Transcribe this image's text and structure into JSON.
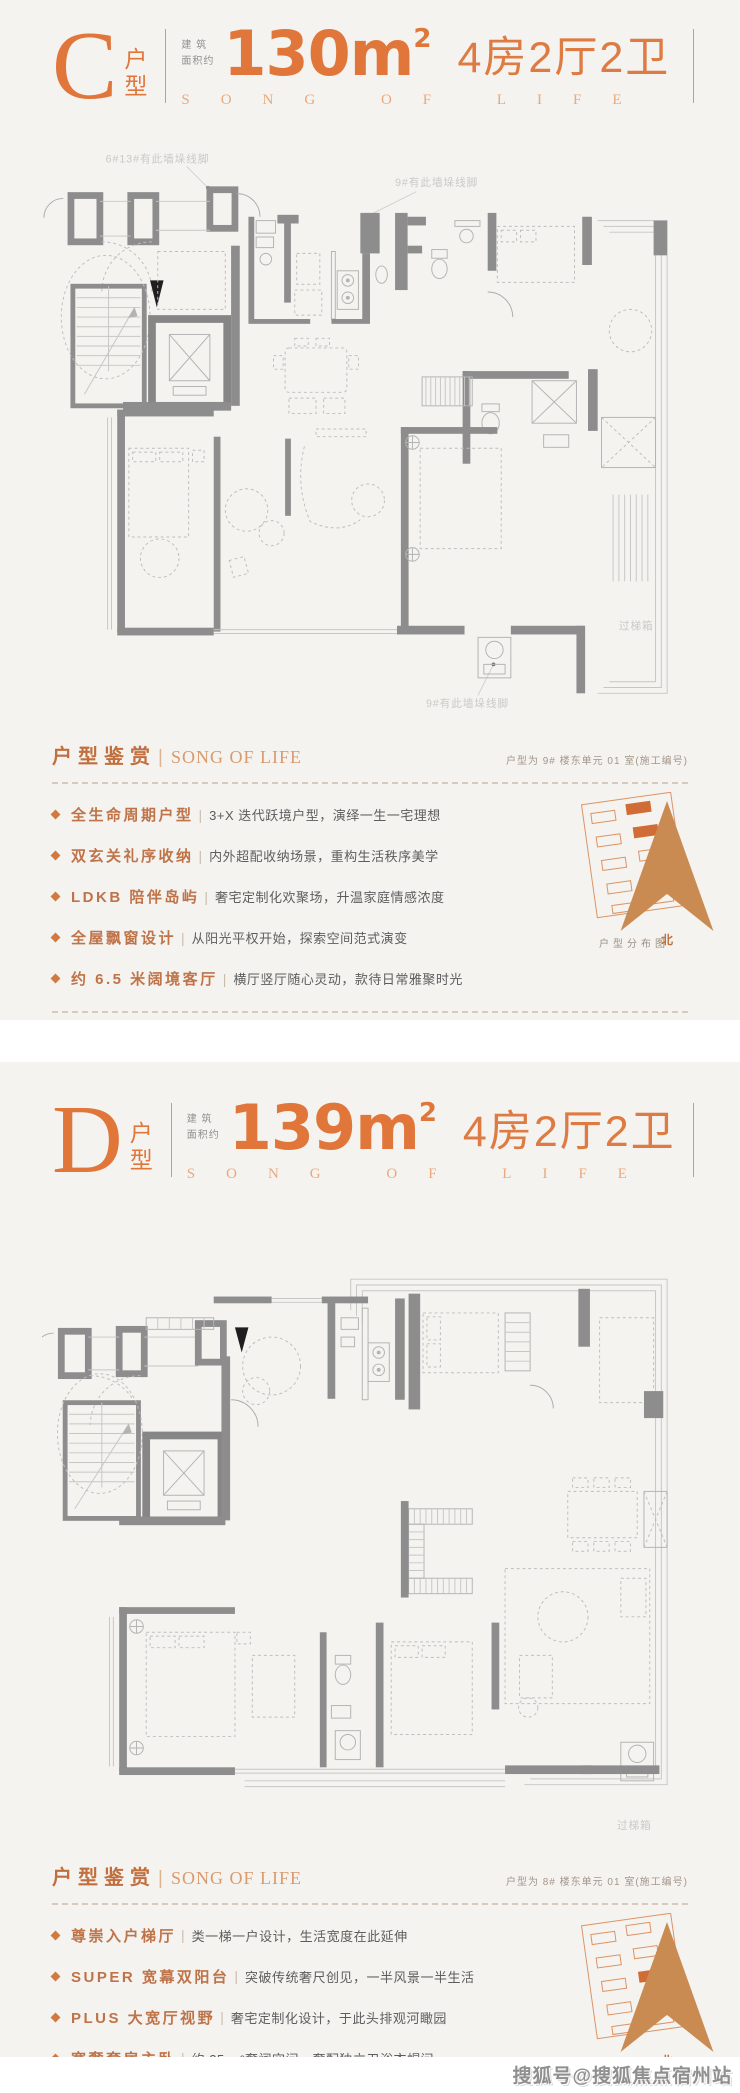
{
  "colors": {
    "accent": "#e1763b",
    "card_bg": "#f4f3f0",
    "section_head": "#c06f3d"
  },
  "watermark": "搜狐号@搜狐焦点宿州站",
  "cards": [
    {
      "letter": "C",
      "suffix": "户型",
      "area_label_1": "建 筑",
      "area_label_2": "面积约",
      "area_number": "130",
      "area_unit": "m",
      "area_sup": "2",
      "rooms": "4房2厅2卫",
      "subtitle": "SONG OF LIFE",
      "section": {
        "title": "户型鉴赏",
        "divider": "|",
        "title_en": "SONG OF LIFE",
        "note": "户型为 9# 楼东单元 01 室(施工编号)",
        "bullets": [
          {
            "head": "全生命周期户型",
            "desc": "3+X 迭代跃境户型，演绎一生一宅理想"
          },
          {
            "head": "双玄关礼序收纳",
            "desc": "内外超配收纳场景，重构生活秩序美学"
          },
          {
            "head": "LDKB 陪伴岛屿",
            "desc": "奢宅定制化欢聚场，升温家庭情感浓度"
          },
          {
            "head": "全屋飘窗设计",
            "desc": "从阳光平权开始，探索空间范式演变"
          },
          {
            "head": "约 6.5 米阔境客厅",
            "desc": "横厅竖厅随心灵动，款待日常雅聚时光"
          }
        ],
        "thumb_caption": "户型分布图",
        "compass_label": "北"
      },
      "plan_annotations": {
        "top_left": "6#13#有此墙垛线脚",
        "top_right": "9#有此墙垛线脚",
        "bottom": "9#有此墙垛线脚",
        "side": "过梯箱"
      }
    },
    {
      "letter": "D",
      "suffix": "户型",
      "area_label_1": "建 筑",
      "area_label_2": "面积约",
      "area_number": "139",
      "area_unit": "m",
      "area_sup": "2",
      "rooms": "4房2厅2卫",
      "subtitle": "SONG OF LIFE",
      "section": {
        "title": "户型鉴赏",
        "divider": "|",
        "title_en": "SONG OF LIFE",
        "note": "户型为 8# 楼东单元 01 室(施工编号)",
        "bullets": [
          {
            "head": "尊崇入户梯厅",
            "desc": "类一梯一户设计，生活宽度在此延伸"
          },
          {
            "head": "SUPER 宽幕双阳台",
            "desc": "突破传统奢尺创见，一半风景一半生活"
          },
          {
            "head": "PLUS 大宽厅视野",
            "desc": "奢宅定制化设计，于此头排观河瞰园"
          },
          {
            "head": "宽奢套房主卧",
            "desc": "约 25 m²奢阔空间，奢配独立卫浴衣帽间"
          },
          {
            "head": "270°转角飘窗",
            "desc": "无柱设计广角观景，四季于窗前成诗"
          }
        ],
        "thumb_caption": "户型分布图",
        "compass_label": "北"
      },
      "plan_annotations": {
        "side": "过梯箱"
      }
    }
  ]
}
